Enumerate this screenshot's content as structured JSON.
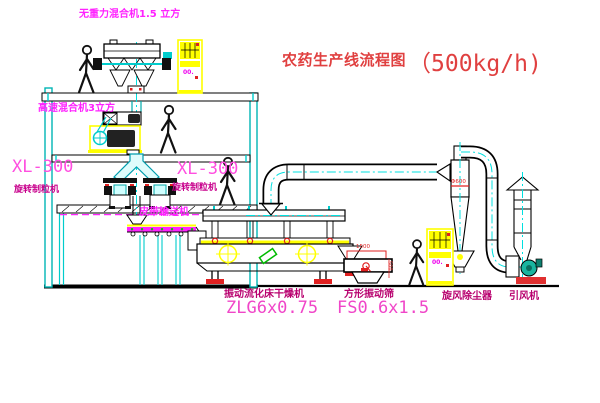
{
  "title": {
    "name_cn": "农药生产线流程图",
    "capacity": "（500kg/h)"
  },
  "equipment_labels": {
    "gravity_free_mixer": "无重力混合机1.5 立方",
    "high_speed_mixer": "高速混合机3立方",
    "granulator_left_model": "XL-300",
    "granulator_left_name": "旋转制粒机",
    "granulator_right_model": "XL-300",
    "granulator_right_name": "旋转制粒机",
    "belt_conveyor": "皮带输送机",
    "fluid_bed_dryer_name": "振动流化床干燥机",
    "fluid_bed_dryer_model": "ZLG6x0.75",
    "vibrating_screen_name": "方形振动筛",
    "vibrating_screen_model": "FS0.6x1.5",
    "cyclone": "旋风除尘器",
    "induced_draft_fan": "引风机"
  },
  "dimensions": {
    "screen_length": "1500",
    "screen_height": "500",
    "cyclone_diameter": "Φ600"
  },
  "control_cabinets": {
    "top_indicator": "00.",
    "right_indicator": "00."
  },
  "colors": {
    "line_black": "#000000",
    "centerline_cyan": "#00E0E0",
    "label_magenta": "#FF22FF",
    "label_dark_magenta": "#B8006E",
    "model_pink": "#F046C8",
    "title_red": "#E04040",
    "cabinet_yellow": "#FFFF00",
    "alert_red": "#E02020",
    "machine_teal": "#00AAAA",
    "green_accent": "#00BB00"
  }
}
